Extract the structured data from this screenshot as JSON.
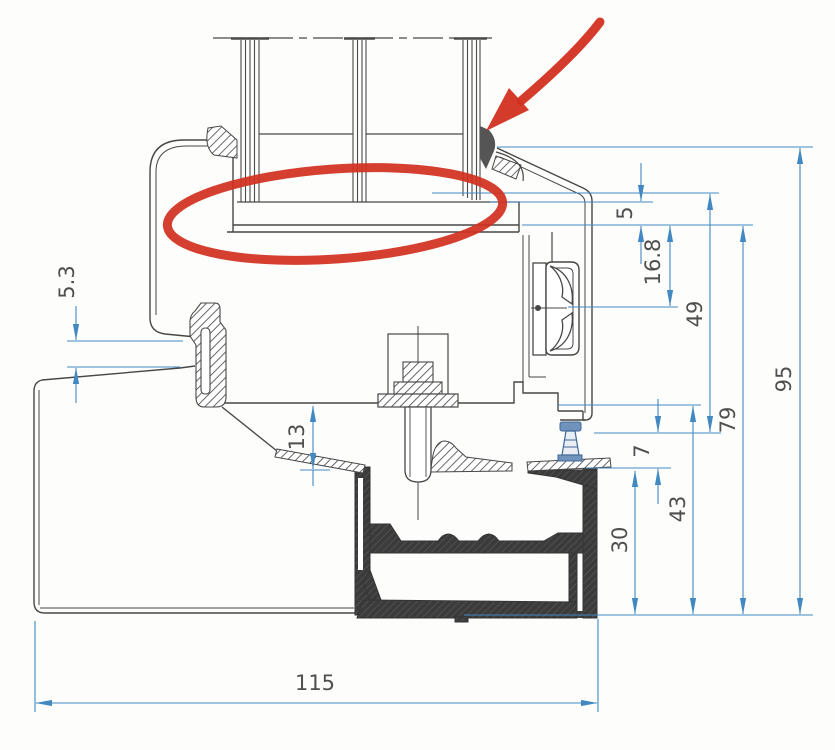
{
  "drawing": {
    "title": "window-sill-cross-section",
    "type": "technical-profile-drawing"
  },
  "dims": {
    "d53": "5.3",
    "d13": "13",
    "d115": "115",
    "d5": "5",
    "d168": "16.8",
    "d49": "49",
    "d79": "79",
    "d95": "95",
    "d7": "7",
    "d43": "43",
    "d30": "30"
  },
  "colors": {
    "dimension_blue": "#4289c2",
    "annotation_red": "#d2301f",
    "profile_line": "#474747",
    "sill_dark": "#3b3b3b"
  },
  "annotations": {
    "ellipse": "glazing-seat-highlight",
    "arrow": "outer-gasket-pointer"
  }
}
